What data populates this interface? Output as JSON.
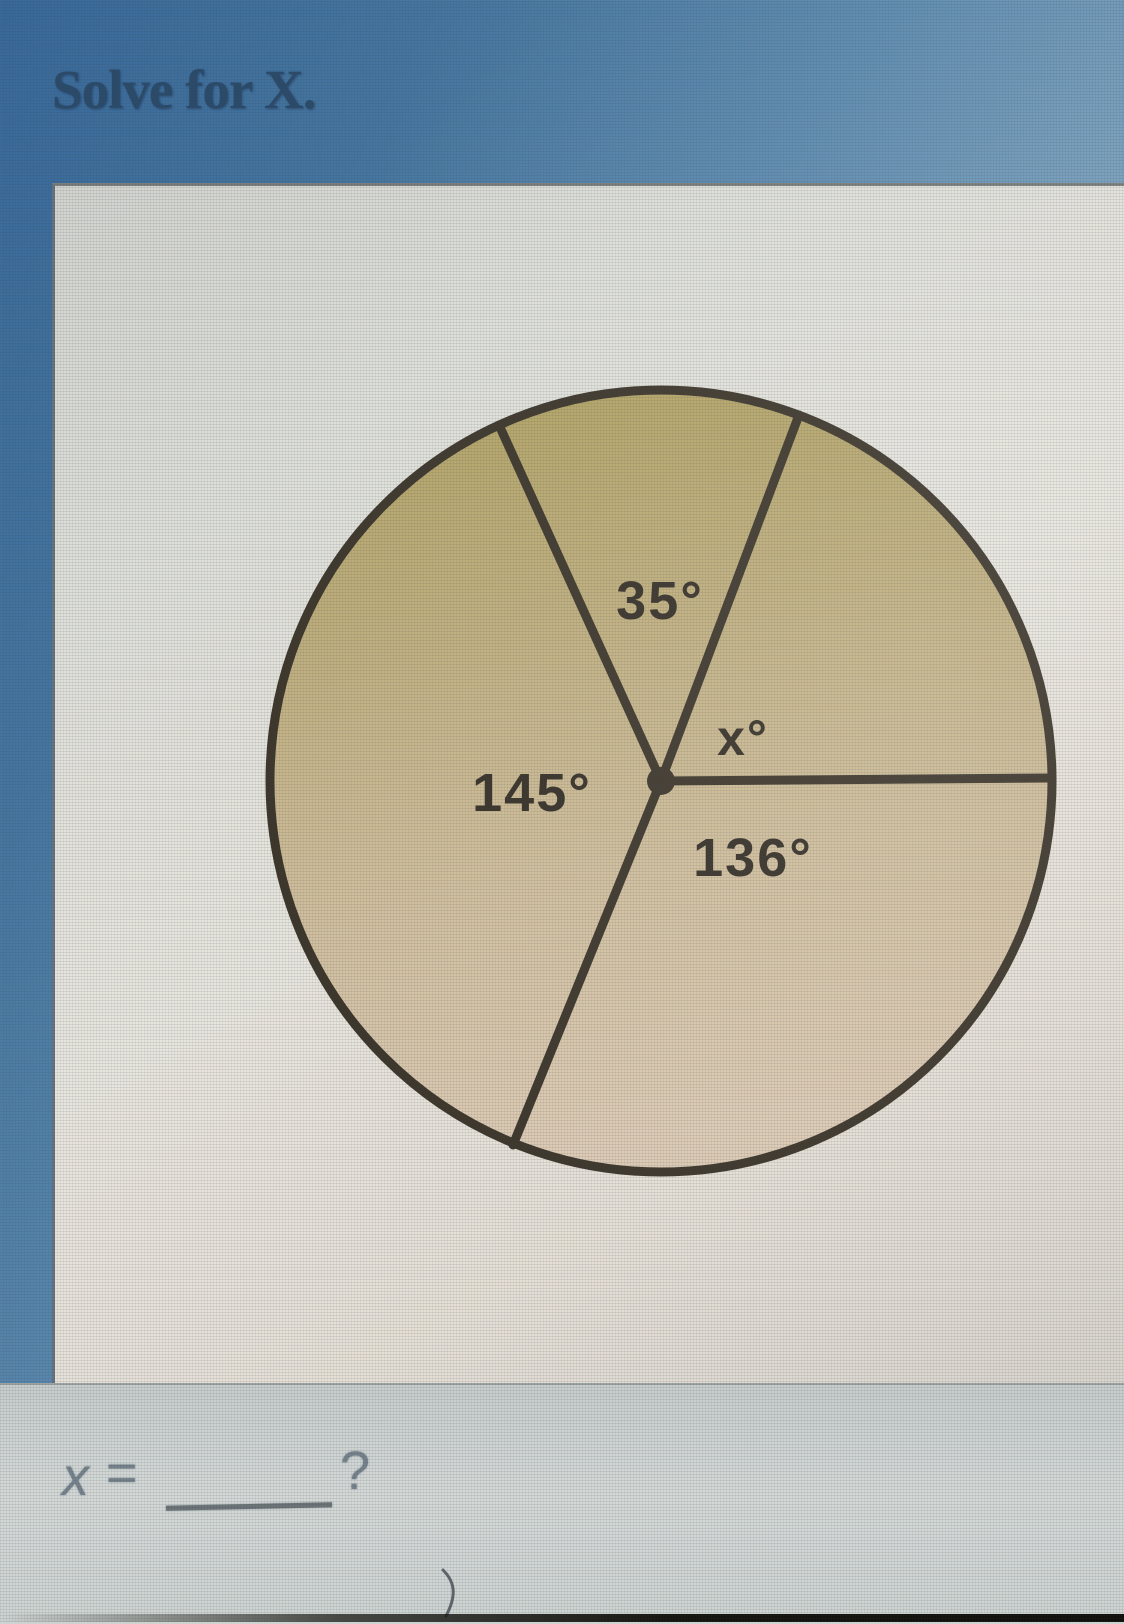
{
  "page": {
    "title": "Solve for X."
  },
  "diagram": {
    "type": "circle-central-angles",
    "description": "Circle divided by four radii into four central angles; three angles are labeled and one is unknown (x)",
    "labels": {
      "top_sector": "35°",
      "right_sector": "x°",
      "bottom_right_sector": "136°",
      "left_sector": "145°"
    },
    "known_angles_degrees": [
      35,
      136,
      145
    ],
    "unknown_variable": "x",
    "colors": {
      "line": "#3c352a",
      "fill_top": "#b0a161",
      "fill_bottom": "#dccab4"
    }
  },
  "answer_line": {
    "variable": "x",
    "equals": "=",
    "question_mark": "?"
  }
}
